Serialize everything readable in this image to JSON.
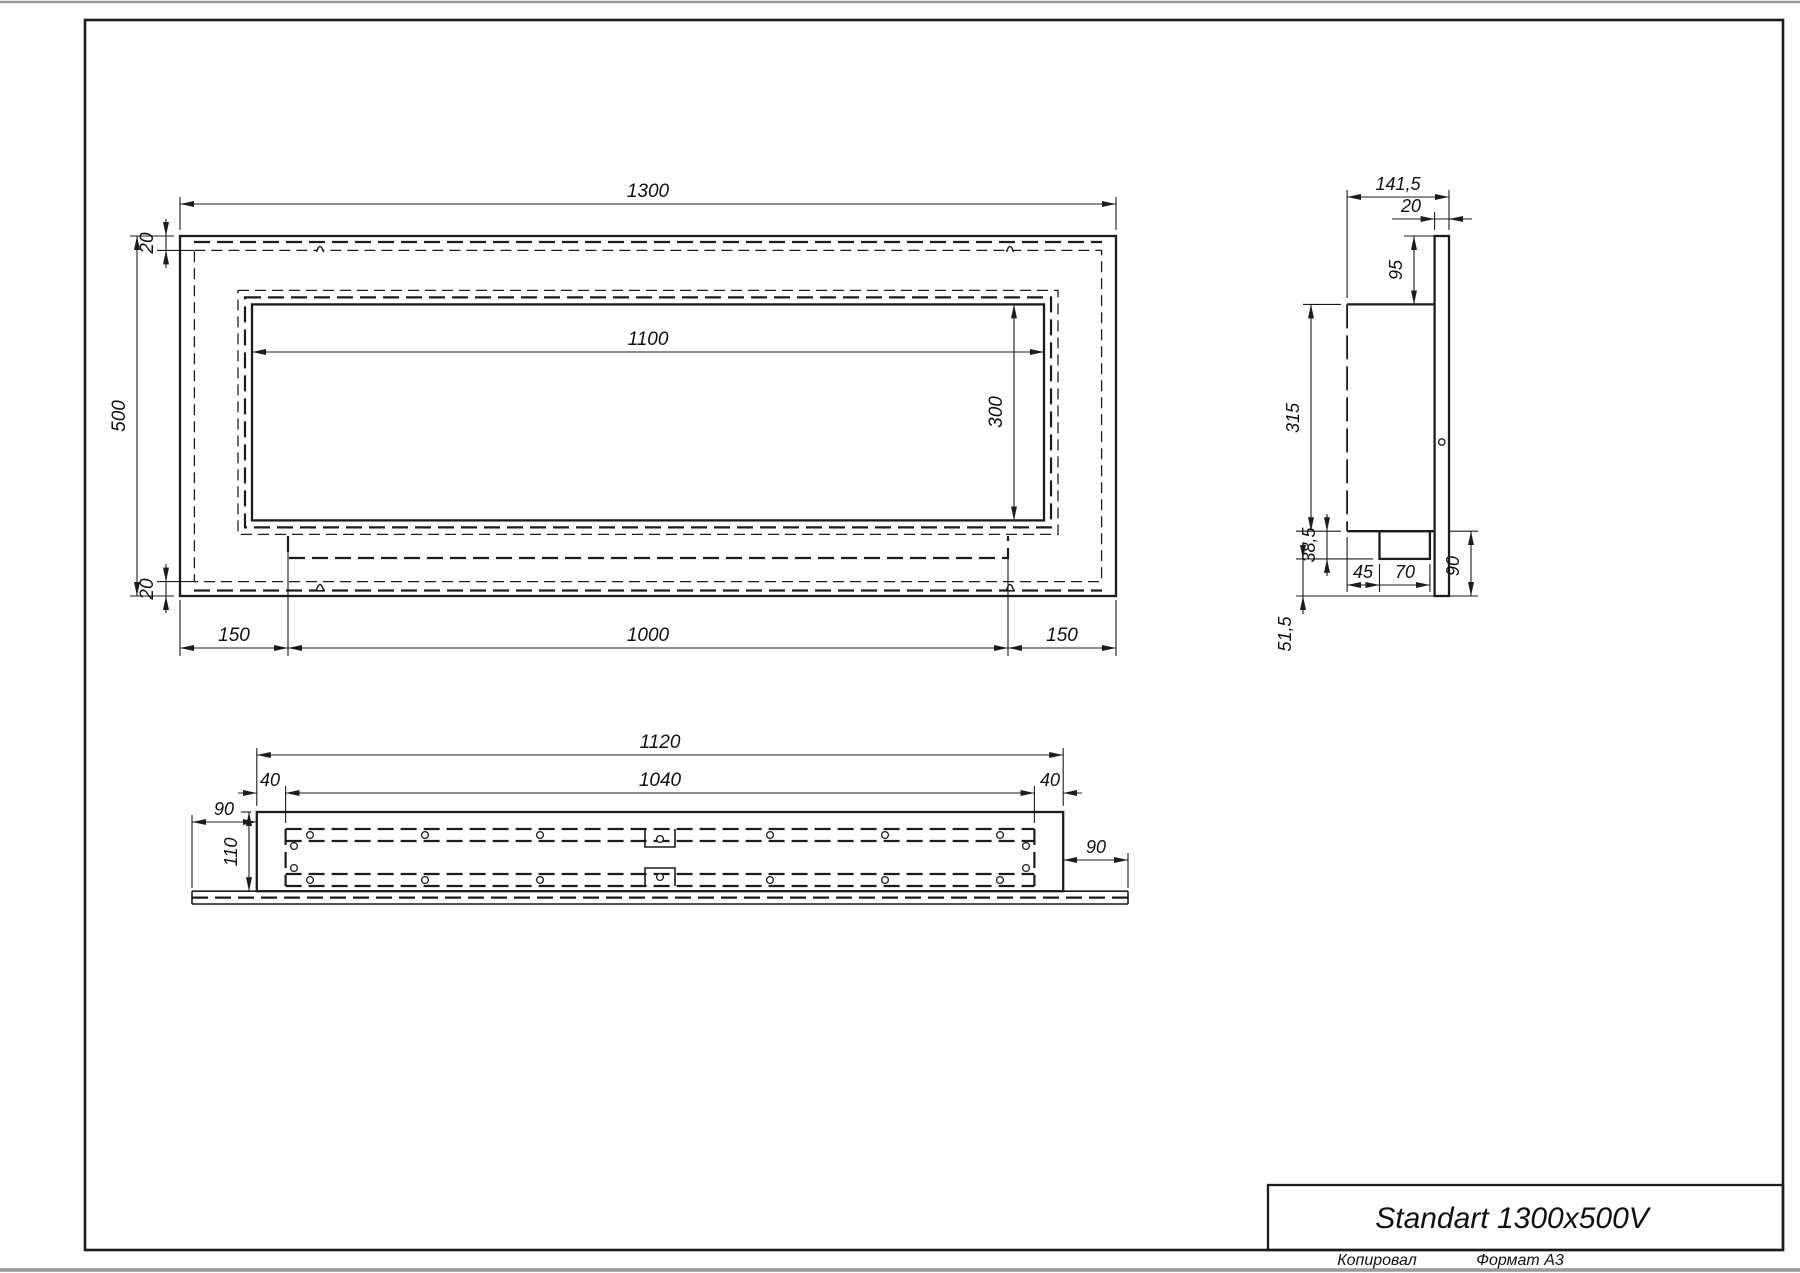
{
  "title_block": {
    "model": "Standart 1300x500V",
    "copied": "Копировал",
    "format": "Формат А3"
  },
  "front_view": {
    "dim_width": "1300",
    "dim_height": "500",
    "dim_top_inset": "20",
    "dim_bottom_inset": "20",
    "dim_opening_width": "1100",
    "dim_opening_height": "300",
    "dim_left": "150",
    "dim_center": "1000",
    "dim_right": "150"
  },
  "side_view": {
    "dim_depth": "141,5",
    "dim_panel_thickness": "20",
    "dim_top_offset": "95",
    "dim_body_height": "315",
    "dim_tray_depth": "38,5",
    "dim_below_tray": "51,5",
    "dim_tray_offset": "45",
    "dim_tray_width": "70",
    "dim_bottom_height": "90"
  },
  "bottom_view": {
    "dim_outer_width": "1120",
    "dim_inner_width": "1040",
    "dim_flange_left": "40",
    "dim_flange_right": "40",
    "dim_overhang_left": "90",
    "dim_overhang_right": "90",
    "dim_depth": "110"
  }
}
